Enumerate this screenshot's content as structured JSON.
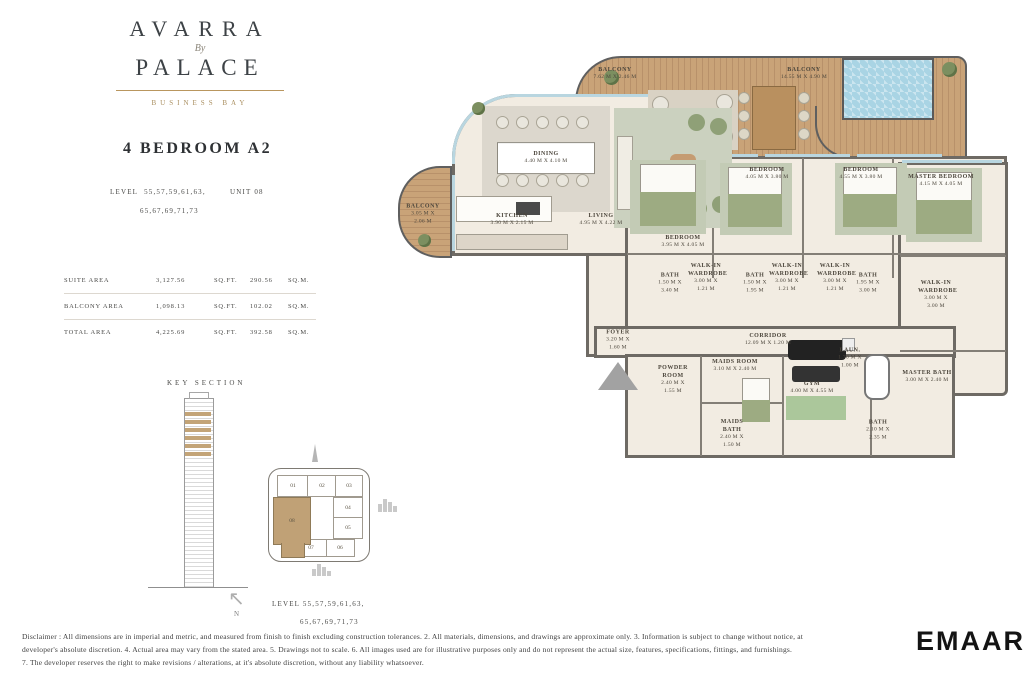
{
  "brand": {
    "name_line1": "AVARRA",
    "by": "By",
    "name_line2": "PALACE",
    "subtitle": "BUSINESS BAY"
  },
  "unit": {
    "title": "4 BEDROOM A2",
    "level_label": "LEVEL",
    "level_line1": "55,57,59,61,63,",
    "level_line2": "65,67,69,71,73",
    "unit_label": "UNIT 08"
  },
  "areas": {
    "rows": [
      {
        "label": "SUITE AREA",
        "sqft": "3,127.56",
        "sqft_unit": "SQ.FT.",
        "sqm": "290.56",
        "sqm_unit": "SQ.M."
      },
      {
        "label": "BALCONY AREA",
        "sqft": "1,098.13",
        "sqft_unit": "SQ.FT.",
        "sqm": "102.02",
        "sqm_unit": "SQ.M."
      },
      {
        "label": "TOTAL AREA",
        "sqft": "4,225.69",
        "sqft_unit": "SQ.FT.",
        "sqm": "392.58",
        "sqm_unit": "SQ.M."
      }
    ]
  },
  "key_section": {
    "title": "KEY SECTION"
  },
  "key_plan": {
    "units": [
      "01",
      "02",
      "03",
      "04",
      "05",
      "06",
      "07",
      "08"
    ],
    "highlighted_unit": "08",
    "north_label": "N",
    "level_line1": "LEVEL  55,57,59,61,63,",
    "level_line2": "65,67,69,71,73"
  },
  "floorplan": {
    "rooms": [
      {
        "name": "BALCONY",
        "dims": "7.62 m X 2.46 m"
      },
      {
        "name": "BALCONY",
        "dims": "14.55 m X 4.90 m"
      },
      {
        "name": "BALCONY",
        "dims": "3.05 m X 2.06 m"
      },
      {
        "name": "DINING",
        "dims": "4.40 m X 4.10 m"
      },
      {
        "name": "KITCHEN",
        "dims": "3.90 m X 2.15 m"
      },
      {
        "name": "LIVING",
        "dims": "4.95 m X 4.22 m"
      },
      {
        "name": "BEDROOM",
        "dims": "3.95 m X 4.05 m"
      },
      {
        "name": "BEDROOM",
        "dims": "4.05 m X 3.80 m"
      },
      {
        "name": "BEDROOM",
        "dims": "4.55 m X 3.80 m"
      },
      {
        "name": "MASTER BEDROOM",
        "dims": "4.15 m X 4.05 m"
      },
      {
        "name": "BATH",
        "dims": "1.50 m X 3.40 m"
      },
      {
        "name": "WALK-IN WARDROBE",
        "dims": "3.00 m X 1.21 m"
      },
      {
        "name": "BATH",
        "dims": "1.50 m X 1.95 m"
      },
      {
        "name": "WALK-IN WARDROBE",
        "dims": "3.00 m X 1.21 m"
      },
      {
        "name": "WALK-IN WARDROBE",
        "dims": "3.00 m X 1.21 m"
      },
      {
        "name": "BATH",
        "dims": "1.95 m X 3.00 m"
      },
      {
        "name": "MASTER BATH",
        "dims": "3.00 m X 2.40 m"
      },
      {
        "name": "WALK-IN WARDROBE",
        "dims": "3.00 m X 3.00 m"
      },
      {
        "name": "FOYER",
        "dims": "3.20 m X 1.60 m"
      },
      {
        "name": "CORRIDOR",
        "dims": "12.09 m X 1.20 m"
      },
      {
        "name": "POWDER ROOM",
        "dims": "2.40 m X 1.55 m"
      },
      {
        "name": "MAIDS ROOM",
        "dims": "3.10 m X 2.40 m"
      },
      {
        "name": "MAIDS BATH",
        "dims": "2.40 m X 1.50 m"
      },
      {
        "name": "GYM",
        "dims": "4.00 m X 4.55 m"
      },
      {
        "name": "LAUN.",
        "dims": "1.70 m X 1.00 m"
      },
      {
        "name": "BATH",
        "dims": "2.10 m X 2.35 m"
      }
    ]
  },
  "disclaimer": {
    "line1": "Disclaimer : All dimensions are in imperial and metric, and measured from finish to finish excluding construction tolerances. 2. All materials, dimensions, and drawings are approximate only. 3. Information is subject to change without notice, at",
    "line2": "developer's absolute discretion. 4. Actual area may vary from the stated area. 5. Drawings not to scale. 6. All images used are for illustrative purposes only and do not represent the actual size, features, specifications, fittings, and furnishings.",
    "line3": "7. The developer reserves the right to make revisions / alterations, at it's absolute discretion, without any liability whatsoever."
  },
  "footer": {
    "logo": "EMAAR"
  },
  "colors": {
    "accent_gold": "#b9965e",
    "deck_wood": "#c9a378",
    "wall_gray": "#6e6a64",
    "interior_floor": "#f2ece2",
    "pool_blue": "#a9d4e4",
    "keyplan_highlight": "#c0a176"
  }
}
